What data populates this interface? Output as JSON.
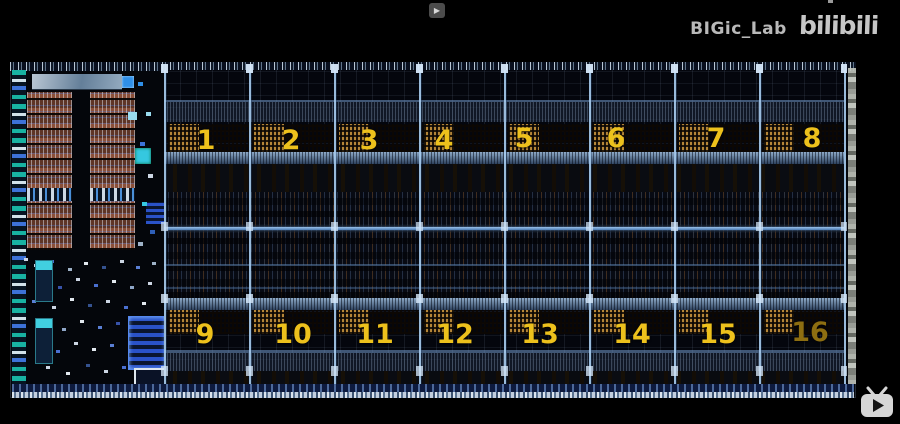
{
  "header": {
    "brand_text": "BIGic_Lab",
    "logo_text": "bilibili",
    "video_badge_glyph": "▶"
  },
  "die_annotation": {
    "labels": [
      {
        "text": "1"
      },
      {
        "text": "2"
      },
      {
        "text": "3"
      },
      {
        "text": "4"
      },
      {
        "text": "5"
      },
      {
        "text": "6"
      },
      {
        "text": "7"
      },
      {
        "text": "8"
      },
      {
        "text": "9"
      },
      {
        "text": "10"
      },
      {
        "text": "11"
      },
      {
        "text": "12"
      },
      {
        "text": "13"
      },
      {
        "text": "14"
      },
      {
        "text": "15"
      },
      {
        "text": "16"
      }
    ],
    "label_color": "#edc11c",
    "label_color_dim": "#8d6e11"
  },
  "icons": {
    "top_center": "video-play-badge-icon",
    "bottom_right": "bilibili-tv-icon"
  },
  "colors": {
    "background": "#000000",
    "die_base": "#05070d",
    "divider_blue": "#a8cdf0",
    "gold_block": "#d29b40",
    "pad_teal": "#18b2a2",
    "logo_grey": "#bdbdbd"
  }
}
